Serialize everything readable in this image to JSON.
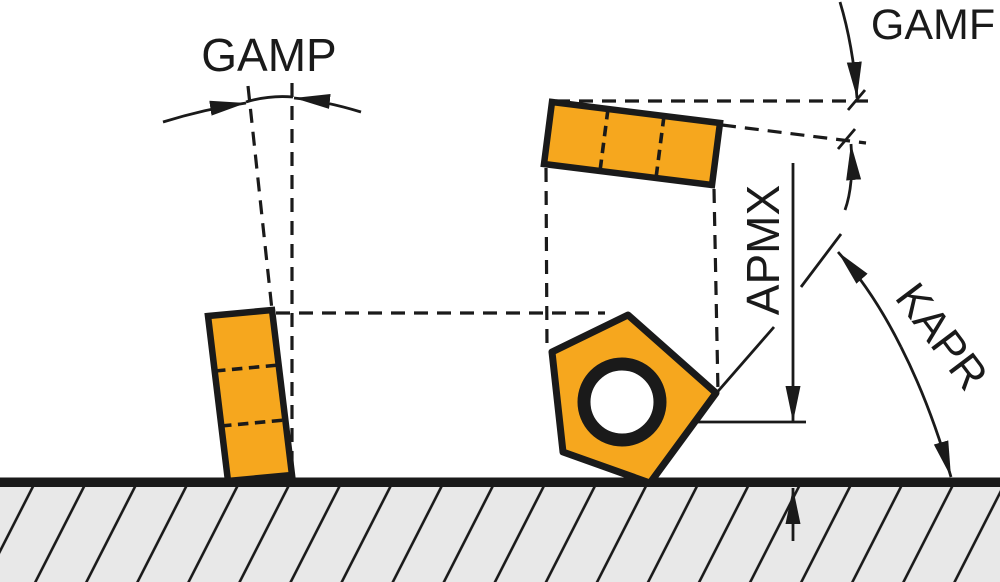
{
  "labels": {
    "gamp": "GAMP",
    "gamf": "GAMF",
    "apmx": "APMX",
    "kapr": "KAPR"
  },
  "colors": {
    "insert_orange": "#F6A71E",
    "line_ink": "#1A1A1A",
    "workpiece_gray": "#E8E8E8",
    "background": "#FFFFFF"
  }
}
